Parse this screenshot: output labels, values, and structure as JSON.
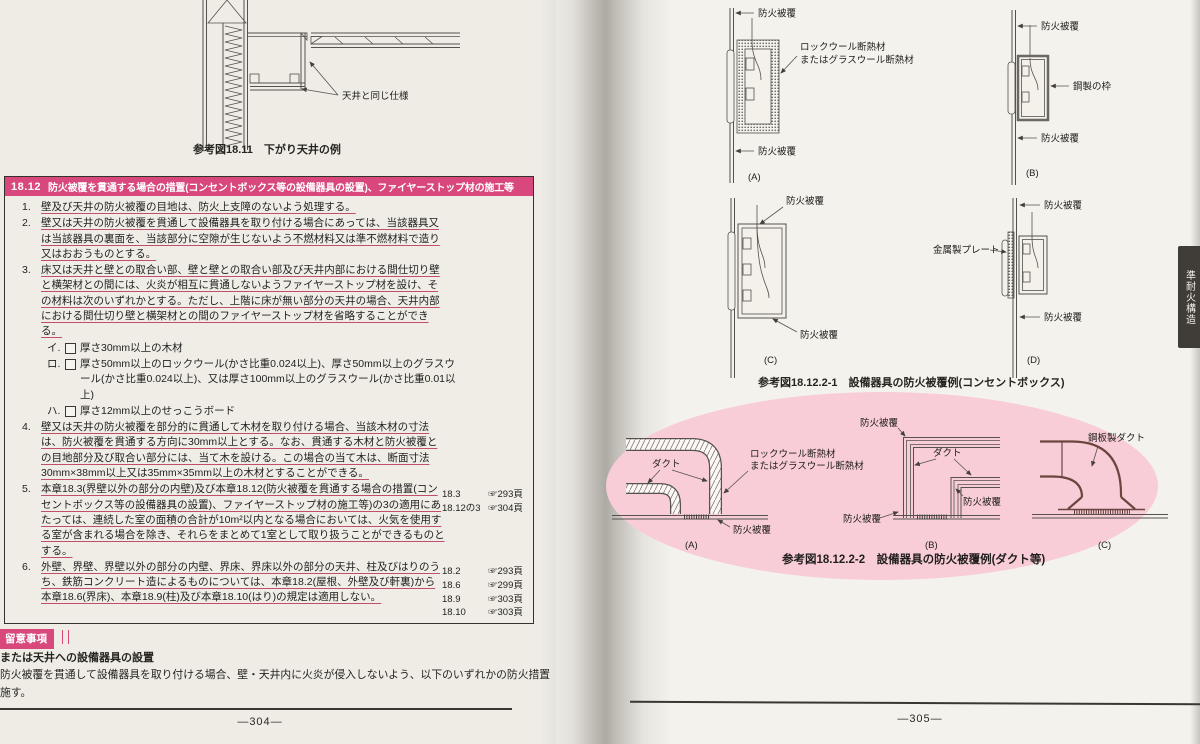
{
  "colors": {
    "accent_pink": "#d8487c",
    "ellipse_pink": "#f8cdd8",
    "underline_red": "#c0506a",
    "paper": "#f1efe8"
  },
  "left_page": {
    "fig_18_11": {
      "annotation": "天井と同じ仕様",
      "caption": "参考図18.11　下がり天井の例"
    },
    "section": {
      "number": "18.12",
      "title": "防火被覆を貫通する場合の措置(コンセントボックス等の設備器具の設置)、ファイヤーストップ材の施工等",
      "items": [
        {
          "num": "1.",
          "text": "壁及び天井の防火被覆の目地は、防火上支障のないよう処理する。"
        },
        {
          "num": "2.",
          "text": "壁又は天井の防火被覆を貫通して設備器具を取り付ける場合にあっては、当該器具又は当該器具の裏面を、当該部分に空隙が生じないよう不燃材料又は準不燃材料で造り又はおおうものとする。"
        },
        {
          "num": "3.",
          "text": "床又は天井と壁との取合い部、壁と壁との取合い部及び天井内部における間仕切り壁と横架材との間には、火炎が相互に貫通しないようファイヤーストップ材を設け、その材料は次のいずれかとする。ただし、上階に床が無い部分の天井の場合、天井内部における間仕切り壁と横架材との間のファイヤーストップ材を省略することができる。"
        },
        {
          "num": "4.",
          "text": "壁又は天井の防火被覆を部分的に貫通して木材を取り付ける場合、当該木材の寸法は、防火被覆を貫通する方向に30mm以上とする。なお、貫通する木材と防火被覆との目地部分及び取合い部分には、当て木を設ける。この場合の当て木は、断面寸法30mm×38mm以上又は35mm×35mm以上の木材とすることができる。"
        },
        {
          "num": "5.",
          "text": "本章18.3(界壁以外の部分の内壁)及び本章18.12(防火被覆を貫通する場合の措置(コンセントボックス等の設備器具の設置)、ファイヤーストップ材の施工等)の3の適用にあたっては、連続した室の面積の合計が10m²以内となる場合においては、火気を使用する室が含まれる場合を除き、それらをまとめて1室として取り扱うことができるものとする。"
        },
        {
          "num": "6.",
          "text": "外壁、界壁、界壁以外の部分の内壁、界床、界床以外の部分の天井、柱及びはりのうち、鉄筋コンクリート造によるものについては、本章18.2(屋根、外壁及び軒裏)から本章18.6(界床)、本章18.9(柱)及び本章18.10(はり)の規定は適用しない。"
        }
      ],
      "sub_items": [
        {
          "kana": "イ.",
          "text": "厚さ30mm以上の木材"
        },
        {
          "kana": "ロ.",
          "text": "厚さ50mm以上のロックウール(かさ比重0.024以上)、厚さ50mm以上のグラスウール(かさ比重0.024以上)、又は厚さ100mm以上のグラスウール(かさ比重0.01以上)"
        },
        {
          "kana": "ハ.",
          "text": "厚さ12mm以上のせっこうボード"
        }
      ],
      "refs_a": [
        {
          "ref": "18.3",
          "page": "☞293頁"
        },
        {
          "ref": "18.12の3",
          "page": "☞304頁"
        }
      ],
      "refs_b": [
        {
          "ref": "18.2",
          "page": "☞293頁"
        },
        {
          "ref": "18.6",
          "page": "☞299頁"
        },
        {
          "ref": "18.9",
          "page": "☞303頁"
        },
        {
          "ref": "18.10",
          "page": "☞303頁"
        }
      ]
    },
    "notes": {
      "badge": "留意事項",
      "heading": "または天井への設備器具の設置",
      "body_line1": "防火被覆を貫通して設備器具を取り付ける場合、壁・天井内に火炎が侵入しないよう、以下のいずれかの防火措置",
      "body_line2": "施す。"
    },
    "page_number": "—304—"
  },
  "right_page": {
    "fig_1": {
      "caption": "参考図18.12.2-1　設備器具の防火被覆例(コンセントボックス)",
      "a": {
        "top": "防火被覆",
        "side1": "ロックウール断熱材",
        "side2": "またはグラスウール断熱材",
        "bottom": "防火被覆",
        "tag": "(A)"
      },
      "b": {
        "top": "防火被覆",
        "side": "鋼製の枠",
        "bottom": "防火被覆",
        "tag": "(B)"
      },
      "c": {
        "top": "防火被覆",
        "bottom": "防火被覆",
        "tag": "(C)"
      },
      "d": {
        "top": "防火被覆",
        "side": "金属製プレート",
        "bottom": "防火被覆",
        "tag": "(D)"
      }
    },
    "fig_2": {
      "caption": "参考図18.12.2-2　設備器具の防火被覆例(ダクト等)",
      "a": {
        "duct": "ダクト",
        "insul1": "ロックウール断熱材",
        "insul2": "またはグラスウール断熱材",
        "cover": "防火被覆",
        "tag": "(A)"
      },
      "b": {
        "cover_top": "防火被覆",
        "duct": "ダクト",
        "cover_mid": "防火被覆",
        "cover_bottom": "防火被覆",
        "tag": "(B)"
      },
      "c": {
        "duct": "鋼板製ダクト",
        "tag": "(C)"
      }
    },
    "side_tab": "準耐火構造",
    "page_number": "—305—"
  }
}
